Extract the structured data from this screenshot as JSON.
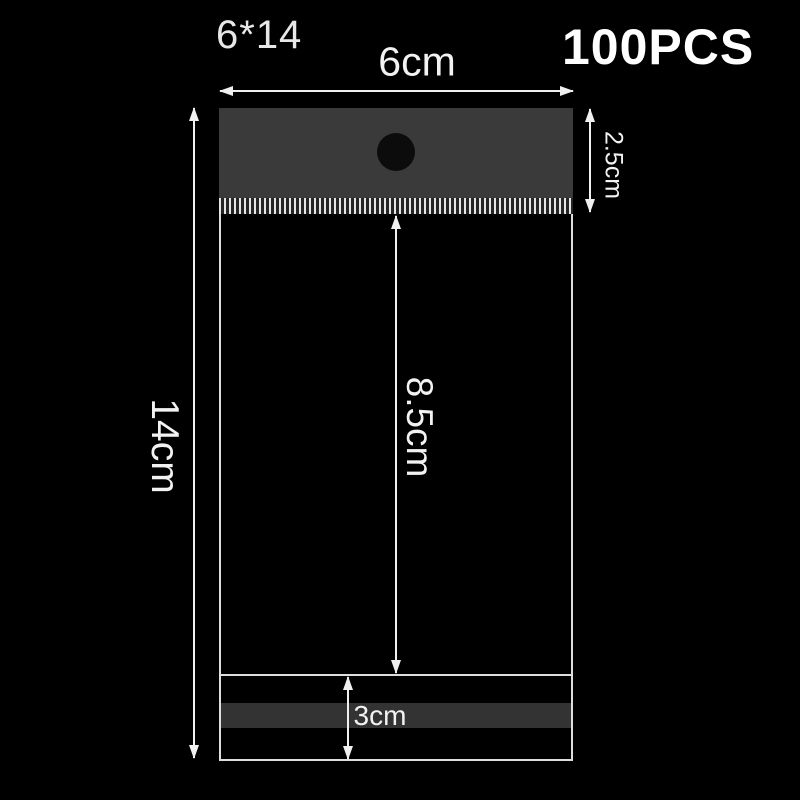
{
  "labels": {
    "product_code": "6*14",
    "quantity": "100PCS"
  },
  "dimensions": {
    "total_width": "6cm",
    "total_height": "14cm",
    "header_height": "2.5cm",
    "body_height": "8.5cm",
    "flap_height": "3cm"
  },
  "colors": {
    "background": "#000000",
    "header_flap": "#3a3a3a",
    "hang_hole": "#0c0c0c",
    "adhesive_strip": "#333333",
    "bag_outline": "#dedede",
    "annotation": "#f0f0f0",
    "text": "#ffffff"
  }
}
